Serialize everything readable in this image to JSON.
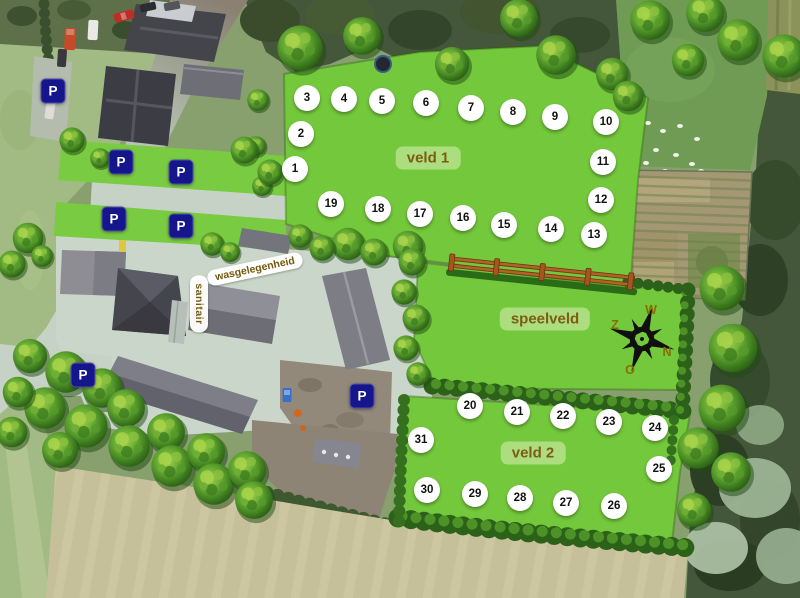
{
  "theme": {
    "label-bg": "rgba(177,223,133,0.92)",
    "label-text": "#7d5c12",
    "pill-bg": "rgba(255,255,255,0.96)",
    "pill-text": "#73590e",
    "parking-bg": "#16168c",
    "parking-text": "#ffffff",
    "pitch-bg": "#ffffff",
    "pitch-text": "#111111",
    "compass-text": "#8a6d00",
    "field-green": "#74c83c"
  },
  "fields": [
    {
      "name": "veld 1",
      "x": 428,
      "y": 158
    },
    {
      "name": "speelveld",
      "x": 545,
      "y": 319
    },
    {
      "name": "veld 2",
      "x": 533,
      "y": 453
    }
  ],
  "facilities": [
    {
      "name": "wasgelegenheid",
      "x": 255,
      "y": 269,
      "rotate": -12
    },
    {
      "name": "sanitair",
      "x": 199,
      "y": 304,
      "vertical": true
    }
  ],
  "pitches": [
    {
      "n": 1,
      "x": 295,
      "y": 169
    },
    {
      "n": 2,
      "x": 301,
      "y": 134
    },
    {
      "n": 3,
      "x": 307,
      "y": 98
    },
    {
      "n": 4,
      "x": 344,
      "y": 99
    },
    {
      "n": 5,
      "x": 382,
      "y": 101
    },
    {
      "n": 6,
      "x": 426,
      "y": 103
    },
    {
      "n": 7,
      "x": 471,
      "y": 108
    },
    {
      "n": 8,
      "x": 513,
      "y": 112
    },
    {
      "n": 9,
      "x": 555,
      "y": 117
    },
    {
      "n": 10,
      "x": 606,
      "y": 122
    },
    {
      "n": 11,
      "x": 603,
      "y": 162
    },
    {
      "n": 12,
      "x": 601,
      "y": 200
    },
    {
      "n": 13,
      "x": 594,
      "y": 235
    },
    {
      "n": 14,
      "x": 551,
      "y": 229
    },
    {
      "n": 15,
      "x": 504,
      "y": 225
    },
    {
      "n": 16,
      "x": 463,
      "y": 218
    },
    {
      "n": 17,
      "x": 420,
      "y": 214
    },
    {
      "n": 18,
      "x": 378,
      "y": 209
    },
    {
      "n": 19,
      "x": 331,
      "y": 204
    },
    {
      "n": 20,
      "x": 470,
      "y": 406
    },
    {
      "n": 21,
      "x": 517,
      "y": 412
    },
    {
      "n": 22,
      "x": 563,
      "y": 416
    },
    {
      "n": 23,
      "x": 609,
      "y": 422
    },
    {
      "n": 24,
      "x": 655,
      "y": 428
    },
    {
      "n": 25,
      "x": 659,
      "y": 469
    },
    {
      "n": 26,
      "x": 614,
      "y": 506
    },
    {
      "n": 27,
      "x": 566,
      "y": 503
    },
    {
      "n": 28,
      "x": 520,
      "y": 498
    },
    {
      "n": 29,
      "x": 475,
      "y": 494
    },
    {
      "n": 30,
      "x": 427,
      "y": 490
    },
    {
      "n": 31,
      "x": 421,
      "y": 440
    }
  ],
  "parking": {
    "label": "P",
    "markers": [
      {
        "x": 53,
        "y": 91
      },
      {
        "x": 121,
        "y": 162
      },
      {
        "x": 181,
        "y": 172
      },
      {
        "x": 114,
        "y": 219
      },
      {
        "x": 181,
        "y": 226
      },
      {
        "x": 83,
        "y": 375
      },
      {
        "x": 362,
        "y": 396
      }
    ]
  },
  "compass": {
    "x": 642,
    "y": 339,
    "rotation": 18,
    "letters": [
      {
        "t": "W",
        "x": 651,
        "y": 310
      },
      {
        "t": "Z",
        "x": 615,
        "y": 325
      },
      {
        "t": "N",
        "x": 667,
        "y": 352
      },
      {
        "t": "O",
        "x": 630,
        "y": 370
      }
    ]
  }
}
